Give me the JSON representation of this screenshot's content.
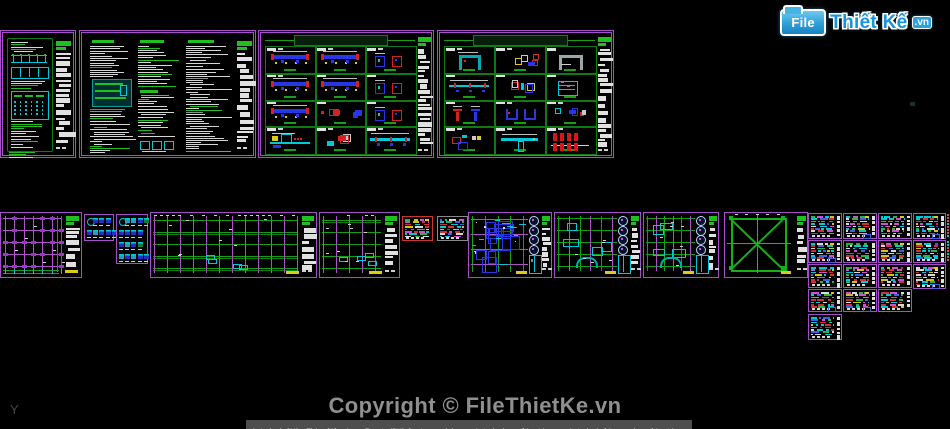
{
  "meta": {
    "width": 950,
    "height": 429,
    "app": "AutoCAD drawing preview"
  },
  "colors": {
    "background": "#000000",
    "sheet_border": "#a44fc8",
    "panel_green": "#0e7a12",
    "bright_green": "#1fbf1f",
    "text_bar": "#d6d6d6",
    "cyan": "#00c8d8",
    "blue": "#2a35e6",
    "red": "#d42222",
    "yellow": "#e0c81e",
    "magenta": "#d050d0",
    "grid_magenta": "#b052c8",
    "purple_marker": "#9a35d4"
  },
  "logo": {
    "file_label": "File",
    "brand_part1": "Thiết",
    "brand_part2": "Kế",
    "tld": ".vn"
  },
  "watermark": {
    "text": "Copyright © FileThietKe.vn",
    "color": "#8f8f8f"
  },
  "status_bar": {
    "text": "Autodesk DWG.  This file is a TrustedDWG last saved by an Autodesk application or Autodesk licensed application."
  },
  "axis_label": "Y",
  "sheet_titles": {
    "details_c": "■■■ ■■■■ ■■ ■■■■ ■■■ ■",
    "details_d": "■■■■ ■■ ■■ ■■■ ■■"
  },
  "sheets": [
    {
      "id": "notes-a",
      "type": "notesPartial",
      "x": 0,
      "y": 30,
      "w": 76,
      "h": 128,
      "seed": 11
    },
    {
      "id": "notes-b",
      "type": "notes3",
      "x": 79,
      "y": 30,
      "w": 177,
      "h": 128,
      "seed": 22
    },
    {
      "id": "details-c",
      "type": "details",
      "x": 258,
      "y": 30,
      "w": 176,
      "h": 128,
      "seed": 33,
      "title_key": "details_c",
      "cells": [
        [
          "beam",
          "beam",
          "sections"
        ],
        [
          "beam",
          "beam",
          "sections"
        ],
        [
          "beam",
          "parts",
          "sections"
        ],
        [
          "machine",
          "parts",
          "longbeam"
        ]
      ]
    },
    {
      "id": "details-d",
      "type": "details",
      "x": 437,
      "y": 30,
      "w": 177,
      "h": 128,
      "seed": 44,
      "title_key": "details_d",
      "cells": [
        [
          "archCyan",
          "parts",
          "archGray"
        ],
        [
          "longbeam",
          "parts",
          "frame"
        ],
        [
          "tees",
          "u",
          "parts"
        ],
        [
          "parts",
          "teewide",
          "redgrid"
        ]
      ]
    },
    {
      "id": "plan-foundation",
      "type": "planGrid",
      "x": 0,
      "y": 212,
      "w": 82,
      "h": 66,
      "seed": 55
    },
    {
      "id": "legend-1",
      "type": "icons",
      "x": 84,
      "y": 214,
      "w": 30,
      "h": 27,
      "seed": 66,
      "rows": 2
    },
    {
      "id": "legend-2",
      "type": "icons",
      "x": 116,
      "y": 214,
      "w": 32,
      "h": 50,
      "seed": 77,
      "rows": 4
    },
    {
      "id": "plan-framing-1",
      "type": "planFraming",
      "x": 150,
      "y": 212,
      "w": 167,
      "h": 66,
      "seed": 88
    },
    {
      "id": "plan-framing-2",
      "type": "planFraming",
      "x": 319,
      "y": 212,
      "w": 81,
      "h": 66,
      "seed": 99
    },
    {
      "id": "schedule-red",
      "type": "schedule",
      "x": 402,
      "y": 216,
      "w": 31,
      "h": 25,
      "seed": 101,
      "border": "#cc3333"
    },
    {
      "id": "schedule-gray",
      "type": "schedule",
      "x": 437,
      "y": 216,
      "w": 31,
      "h": 25,
      "seed": 102,
      "border": "#8a8a8a"
    },
    {
      "id": "plan-dense",
      "type": "planDense",
      "x": 468,
      "y": 212,
      "w": 84,
      "h": 66,
      "seed": 103
    },
    {
      "id": "plan-slab-1",
      "type": "planSlab",
      "x": 554,
      "y": 212,
      "w": 87,
      "h": 66,
      "seed": 104
    },
    {
      "id": "plan-slab-2",
      "type": "planSlab",
      "x": 643,
      "y": 212,
      "w": 76,
      "h": 66,
      "seed": 105
    },
    {
      "id": "plan-brace",
      "type": "planBrace",
      "x": 724,
      "y": 212,
      "w": 84,
      "h": 66,
      "seed": 106
    },
    {
      "id": "sched-r1c1",
      "type": "schedule",
      "x": 808,
      "y": 213,
      "w": 34,
      "h": 26,
      "seed": 110,
      "strip": true
    },
    {
      "id": "sched-r1c2",
      "type": "schedule",
      "x": 843,
      "y": 213,
      "w": 34,
      "h": 26,
      "seed": 111,
      "strip": true
    },
    {
      "id": "sched-r1c3",
      "type": "schedule",
      "x": 878,
      "y": 213,
      "w": 34,
      "h": 26,
      "seed": 112,
      "strip": true
    },
    {
      "id": "sched-r1c4",
      "type": "schedule",
      "x": 913,
      "y": 213,
      "w": 33,
      "h": 26,
      "seed": 113,
      "strip": true
    },
    {
      "id": "sched-r1c5",
      "type": "sliver",
      "x": 947,
      "y": 213,
      "w": 3,
      "h": 26,
      "seed": 114
    },
    {
      "id": "sched-r2c1",
      "type": "schedule",
      "x": 808,
      "y": 240,
      "w": 34,
      "h": 23,
      "seed": 115,
      "strip": true
    },
    {
      "id": "sched-r2c2",
      "type": "schedule",
      "x": 843,
      "y": 240,
      "w": 34,
      "h": 23,
      "seed": 116,
      "strip": true
    },
    {
      "id": "sched-r2c3",
      "type": "schedule",
      "x": 878,
      "y": 240,
      "w": 34,
      "h": 23,
      "seed": 117,
      "strip": true
    },
    {
      "id": "sched-r2c4",
      "type": "schedule",
      "x": 913,
      "y": 240,
      "w": 33,
      "h": 23,
      "seed": 118,
      "strip": true
    },
    {
      "id": "sched-r2c5",
      "type": "sliver",
      "x": 947,
      "y": 240,
      "w": 3,
      "h": 23,
      "seed": 119
    },
    {
      "id": "sched-r3c1",
      "type": "schedule",
      "x": 808,
      "y": 264,
      "w": 34,
      "h": 24,
      "seed": 120,
      "strip": true
    },
    {
      "id": "sched-r3c2",
      "type": "schedule",
      "x": 843,
      "y": 264,
      "w": 34,
      "h": 24,
      "seed": 121,
      "strip": true
    },
    {
      "id": "sched-r3c3",
      "type": "schedule",
      "x": 878,
      "y": 264,
      "w": 34,
      "h": 24,
      "seed": 122,
      "strip": true
    },
    {
      "id": "sched-r3c4",
      "type": "schedule",
      "x": 913,
      "y": 264,
      "w": 33,
      "h": 25,
      "seed": 123,
      "strip": true
    },
    {
      "id": "sched-r4c1",
      "type": "schedule",
      "x": 808,
      "y": 289,
      "w": 34,
      "h": 23,
      "seed": 124,
      "strip": true
    },
    {
      "id": "sched-r4c2",
      "type": "schedule",
      "x": 843,
      "y": 289,
      "w": 34,
      "h": 23,
      "seed": 125,
      "strip": true
    },
    {
      "id": "sched-r4c3",
      "type": "schedule",
      "x": 878,
      "y": 289,
      "w": 34,
      "h": 23,
      "seed": 126,
      "strip": true
    },
    {
      "id": "sched-r5c1",
      "type": "schedule",
      "x": 808,
      "y": 314,
      "w": 34,
      "h": 26,
      "seed": 127,
      "strip": true
    }
  ]
}
